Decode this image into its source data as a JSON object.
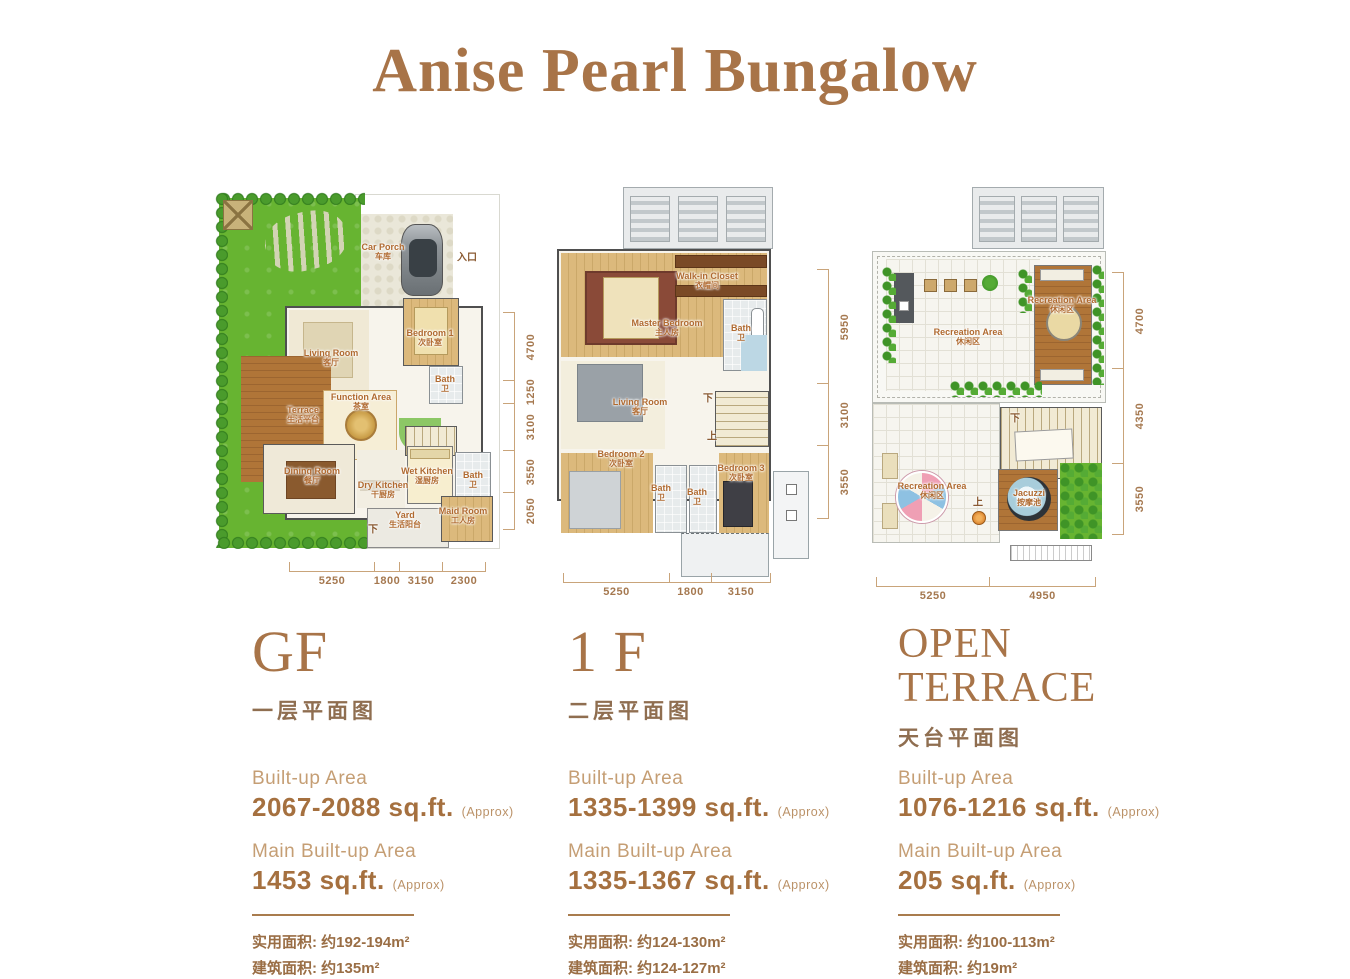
{
  "page": {
    "title": "Anise Pearl Bungalow"
  },
  "colors": {
    "accent_brown": "#a87448",
    "area_label_brown": "#c59e74",
    "area_value_brown": "#a5703f",
    "dimension_brown": "#a5784f"
  },
  "floors": [
    {
      "name": "GF",
      "name_cn": "一层平面图",
      "areas": {
        "built_up_label": "Built-up Area",
        "built_up_value": "2067-2088 sq.ft.",
        "built_up_approx": "(Approx)",
        "main_label": "Main Built-up Area",
        "main_value": "1453 sq.ft.",
        "main_approx": "(Approx)",
        "usable_cn": "实用面积: 约192-194m²",
        "built_cn": "建筑面积: 约135m²"
      },
      "plan": {
        "rooms": [
          {
            "en": "Car Porch",
            "cn": "车库"
          },
          {
            "en": "Living Room",
            "cn": "客厅"
          },
          {
            "en": "Bedroom 1",
            "cn": "次卧室"
          },
          {
            "en": "Bath",
            "cn": "卫"
          },
          {
            "en": "Function Area",
            "cn": "茶室"
          },
          {
            "en": "Terrace",
            "cn": "生活平台"
          },
          {
            "en": "Dining Room",
            "cn": "餐厅"
          },
          {
            "en": "Dry Kitchen",
            "cn": "干厨房"
          },
          {
            "en": "Wet Kitchen",
            "cn": "湿厨房"
          },
          {
            "en": "Bath",
            "cn": "卫"
          },
          {
            "en": "Yard",
            "cn": "生活阳台"
          },
          {
            "en": "Maid Room",
            "cn": "工人房"
          }
        ],
        "marks": {
          "entrance": "入口",
          "down": "下"
        },
        "dims_right": [
          "4700",
          "1250",
          "3100",
          "3550",
          "2050"
        ],
        "dims_bottom": [
          "5250",
          "1800",
          "3150",
          "2300"
        ]
      }
    },
    {
      "name": "1 F",
      "name_cn": "二层平面图",
      "areas": {
        "built_up_label": "Built-up Area",
        "built_up_value": "1335-1399 sq.ft.",
        "built_up_approx": "(Approx)",
        "main_label": "Main Built-up Area",
        "main_value": "1335-1367 sq.ft.",
        "main_approx": "(Approx)",
        "usable_cn": "实用面积: 约124-130m²",
        "built_cn": "建筑面积: 约124-127m²"
      },
      "plan": {
        "rooms": [
          {
            "en": "Walk-in Closet",
            "cn": "衣帽间"
          },
          {
            "en": "Master Bedroom",
            "cn": "主人房"
          },
          {
            "en": "Bath",
            "cn": "卫"
          },
          {
            "en": "Living Room",
            "cn": "客厅"
          },
          {
            "en": "Bedroom 2",
            "cn": "次卧室"
          },
          {
            "en": "Bath",
            "cn": "卫"
          },
          {
            "en": "Bath",
            "cn": "卫"
          },
          {
            "en": "Bedroom 3",
            "cn": "次卧室"
          }
        ],
        "marks": {
          "down": "下",
          "up": "上"
        },
        "dims_right": [
          "5950",
          "3100",
          "3550"
        ],
        "dims_bottom": [
          "5250",
          "1800",
          "3150"
        ]
      }
    },
    {
      "name": "OPEN TERRACE",
      "name_cn": "天台平面图",
      "areas": {
        "built_up_label": "Built-up Area",
        "built_up_value": "1076-1216 sq.ft.",
        "built_up_approx": "(Approx)",
        "main_label": "Main Built-up Area",
        "main_value": "205 sq.ft.",
        "main_approx": "(Approx)",
        "usable_cn": "实用面积: 约100-113m²",
        "built_cn": "建筑面积: 约19m²"
      },
      "plan": {
        "rooms": [
          {
            "en": "Recreation Area",
            "cn": "休闲区"
          },
          {
            "en": "Recreation Area",
            "cn": "休闲区"
          },
          {
            "en": "Recreation Area",
            "cn": "休闲区"
          },
          {
            "en": "Jacuzzi",
            "cn": "按摩池"
          }
        ],
        "marks": {
          "down": "下",
          "up": "上"
        },
        "dims_right": [
          "4700",
          "4350",
          "3550"
        ],
        "dims_bottom": [
          "5250",
          "4950"
        ]
      }
    }
  ]
}
